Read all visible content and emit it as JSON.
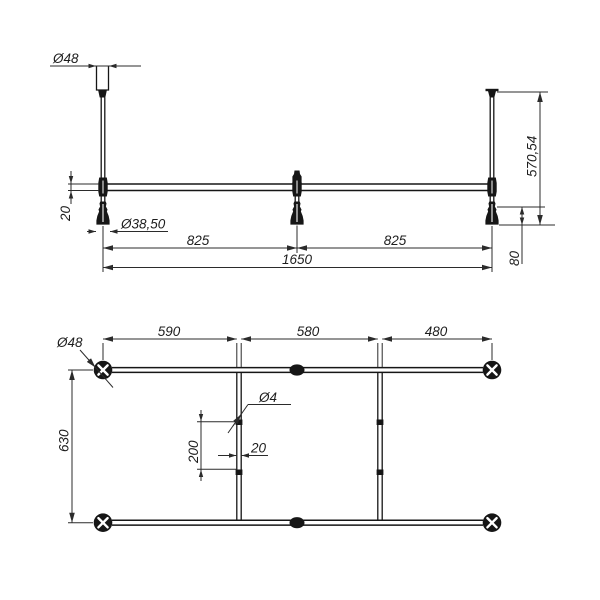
{
  "drawing": {
    "type": "technical-dimension-drawing",
    "colors": {
      "background": "#ffffff",
      "ink": "#161616",
      "dim": "#2b2b2b"
    },
    "elevation": {
      "dim_cap_diameter": "Ø48",
      "dim_rail_height": "20",
      "dim_foot_diameter": "Ø38,50",
      "dim_span_left": "825",
      "dim_span_right": "825",
      "dim_span_total": "1650",
      "dim_overall_height": "570,54",
      "dim_foot_drop": "80"
    },
    "plan": {
      "dim_flange_diameter": "Ø48",
      "dim_bay_left": "590",
      "dim_bay_middle": "580",
      "dim_bay_right": "480",
      "dim_depth": "630",
      "dim_rod_diameter": "Ø4",
      "dim_rod_length": "200",
      "dim_bar_width": "20"
    }
  }
}
